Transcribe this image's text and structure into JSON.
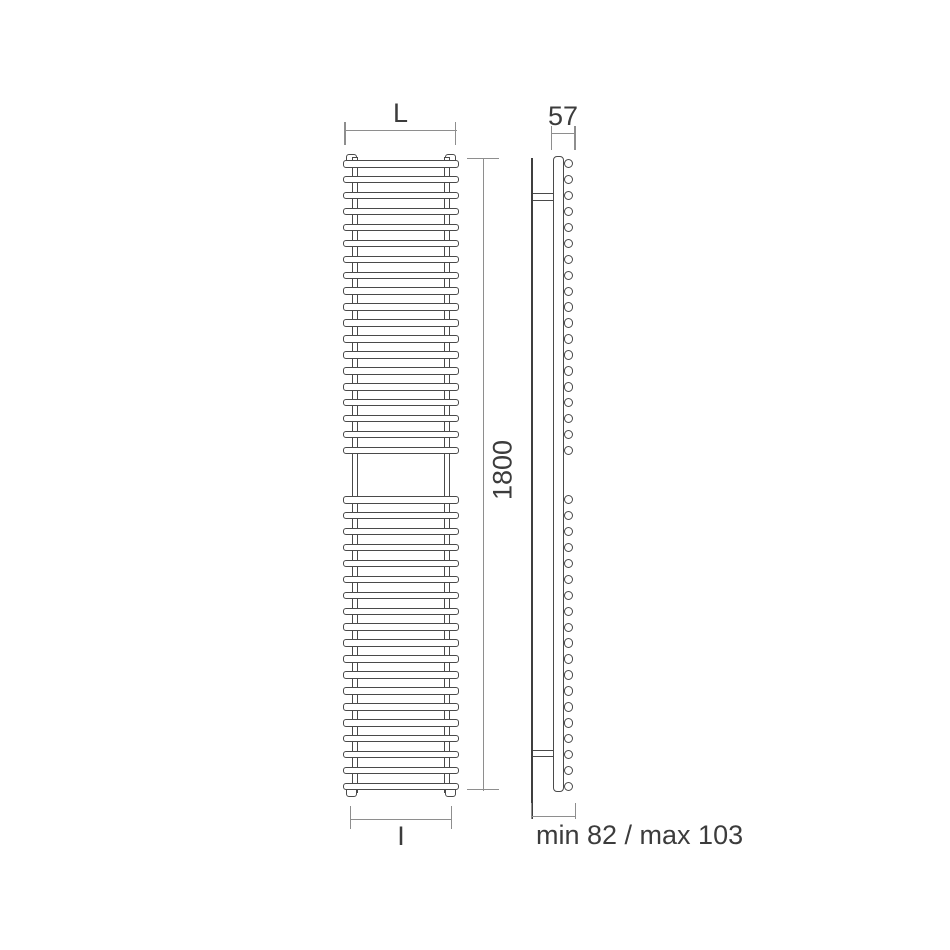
{
  "diagram_type": "radiator technical drawing, front and side elevation",
  "colors": {
    "background": "#ffffff",
    "outline": "#4a4a4a",
    "wall_line": "#3f3f3f",
    "dimension_line": "#8e8e8e",
    "text": "#3c3c3c"
  },
  "labels": {
    "front_width": "L",
    "front_height": "1800",
    "front_interaxis": "I",
    "side_depth": "57",
    "side_wall_distance": "min 82 / max 103"
  },
  "dimensions_shown": {
    "height_mm": 1800,
    "depth_mm": 57,
    "wall_distance_min_mm": 82,
    "wall_distance_max_mm": 103,
    "width_symbol": "L",
    "interaxis_symbol": "I"
  },
  "front_view": {
    "bar_sections": [
      {
        "bars": 19
      },
      {
        "bars": 19
      }
    ]
  },
  "side_view": {
    "tube_sections": [
      {
        "tubes": 19
      },
      {
        "tubes": 19
      }
    ]
  }
}
